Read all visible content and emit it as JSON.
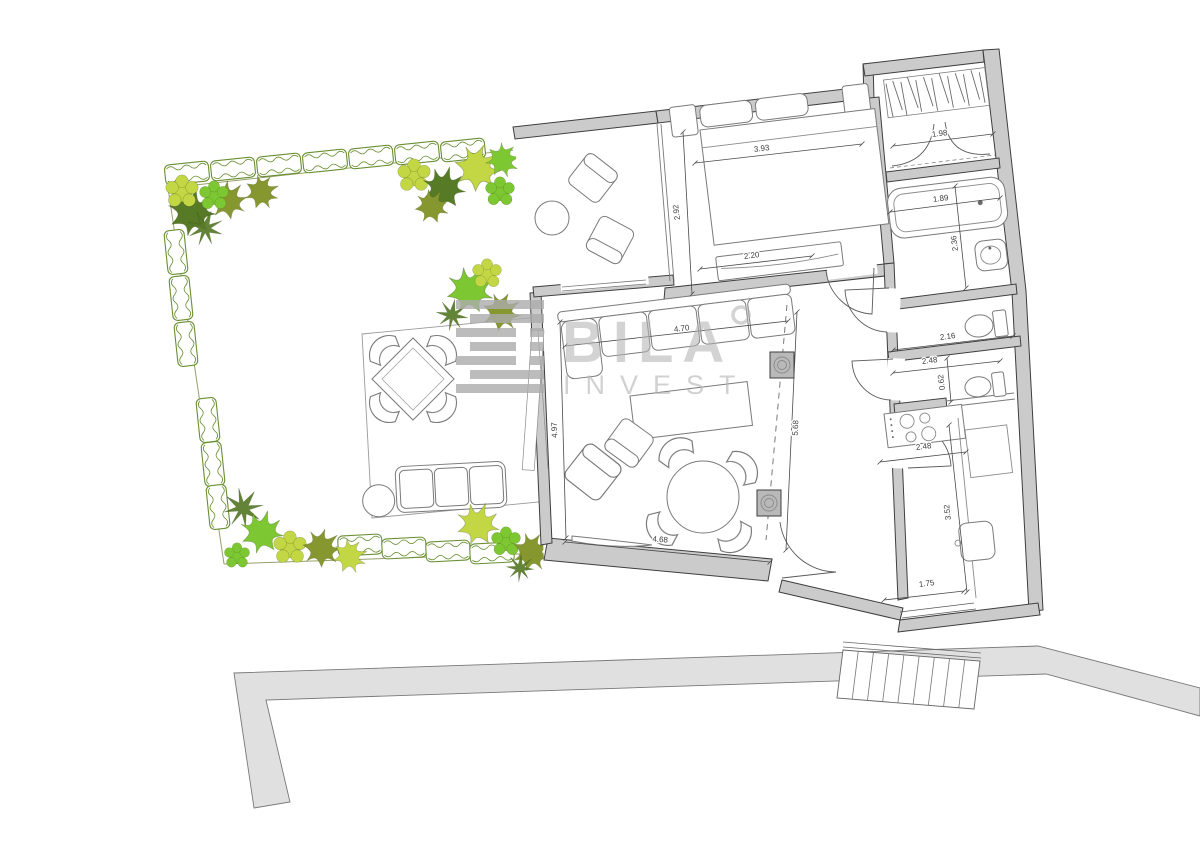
{
  "watermark": {
    "brand": "BILA",
    "sub": "INVEST"
  },
  "colors": {
    "wall_fill": "#cbcbcb",
    "wall_stroke": "#3e3e3e",
    "furniture_stroke": "#7a7a7a",
    "path_fill": "#e0e0e0",
    "watermark_gray": "#b4b4b4",
    "hedge_green": "#6a8f33",
    "plant_bright": "#7dc832",
    "plant_lime": "#c3d745",
    "plant_olive": "#87972f",
    "plant_dark": "#567a26",
    "plant_pale": "#a8cc5a"
  },
  "dimensions": [
    {
      "label": "3.93",
      "x": 762,
      "y": 151,
      "rot": -7,
      "x1": 695,
      "y1": 163,
      "x2": 862,
      "y2": 144
    },
    {
      "label": "2.92",
      "x": 679,
      "y": 212,
      "rot": -97,
      "x1": 683,
      "y1": 132,
      "x2": 692,
      "y2": 294
    },
    {
      "label": "2.20",
      "x": 752,
      "y": 258,
      "rot": -7,
      "x1": 700,
      "y1": 269,
      "x2": 812,
      "y2": 256
    },
    {
      "label": "1.98",
      "x": 940,
      "y": 136,
      "rot": -7,
      "x1": 893,
      "y1": 146,
      "x2": 993,
      "y2": 134
    },
    {
      "label": "1.89",
      "x": 941,
      "y": 201,
      "rot": -7,
      "x1": 890,
      "y1": 212,
      "x2": 1000,
      "y2": 198
    },
    {
      "label": "2.36",
      "x": 957,
      "y": 243,
      "rot": -97,
      "x1": 955,
      "y1": 186,
      "x2": 966,
      "y2": 288
    },
    {
      "label": "2.16",
      "x": 948,
      "y": 339,
      "rot": -7,
      "x1": 893,
      "y1": 350,
      "x2": 1013,
      "y2": 336
    },
    {
      "label": "2.48",
      "x": 930,
      "y": 363,
      "rot": -7,
      "x1": 893,
      "y1": 373,
      "x2": 1000,
      "y2": 361
    },
    {
      "label": "0.62",
      "x": 944,
      "y": 382,
      "rot": -97,
      "x1": 947,
      "y1": 358,
      "x2": 951,
      "y2": 402
    },
    {
      "label": "2.48",
      "x": 924,
      "y": 449,
      "rot": -7,
      "x1": 880,
      "y1": 462,
      "x2": 966,
      "y2": 452
    },
    {
      "label": "3.52",
      "x": 950,
      "y": 512,
      "rot": -96,
      "x1": 949,
      "y1": 425,
      "x2": 967,
      "y2": 592
    },
    {
      "label": "1.75",
      "x": 927,
      "y": 586,
      "rot": -7,
      "x1": 884,
      "y1": 600,
      "x2": 964,
      "y2": 591
    },
    {
      "label": "4.70",
      "x": 682,
      "y": 331,
      "rot": -7,
      "x1": 565,
      "y1": 346,
      "x2": 788,
      "y2": 321
    },
    {
      "label": "4.97",
      "x": 557,
      "y": 430,
      "rot": -92,
      "x1": 560,
      "y1": 322,
      "x2": 566,
      "y2": 538
    },
    {
      "label": "5.68",
      "x": 798,
      "y": 428,
      "rot": -87,
      "x1": 797,
      "y1": 312,
      "x2": 786,
      "y2": 550
    },
    {
      "label": "4.68",
      "x": 660,
      "y": 542,
      "rot": 5,
      "x1": 565,
      "y1": 542,
      "x2": 770,
      "y2": 562
    }
  ],
  "garden": {
    "hedges": [
      {
        "x": 187,
        "y": 173,
        "r": -6
      },
      {
        "x": 233,
        "y": 169,
        "r": -6
      },
      {
        "x": 279,
        "y": 165,
        "r": -6
      },
      {
        "x": 325,
        "y": 161,
        "r": -6
      },
      {
        "x": 371,
        "y": 157,
        "r": -6
      },
      {
        "x": 417,
        "y": 153,
        "r": -6
      },
      {
        "x": 463,
        "y": 150,
        "r": -6
      },
      {
        "x": 176,
        "y": 252,
        "r": 84
      },
      {
        "x": 181,
        "y": 298,
        "r": 84
      },
      {
        "x": 186,
        "y": 344,
        "r": 84
      },
      {
        "x": 208,
        "y": 420,
        "r": 84
      },
      {
        "x": 213,
        "y": 464,
        "r": 84
      },
      {
        "x": 218,
        "y": 507,
        "r": 84
      },
      {
        "x": 360,
        "y": 545,
        "r": -3
      },
      {
        "x": 404,
        "y": 548,
        "r": -3
      },
      {
        "x": 448,
        "y": 551,
        "r": -3
      },
      {
        "x": 492,
        "y": 553,
        "r": -3
      }
    ],
    "plants": [
      {
        "t": "palm",
        "x": 192,
        "y": 212,
        "s": 1.1,
        "r": 10,
        "c": "#567a26"
      },
      {
        "t": "palm",
        "x": 228,
        "y": 200,
        "s": 0.9,
        "r": 40,
        "c": "#87972f"
      },
      {
        "t": "bush",
        "x": 182,
        "y": 192,
        "s": 0.9,
        "r": 0,
        "c": "#c3d745"
      },
      {
        "t": "palm",
        "x": 262,
        "y": 192,
        "s": 0.8,
        "r": 70,
        "c": "#87972f"
      },
      {
        "t": "bush",
        "x": 214,
        "y": 196,
        "s": 0.8,
        "r": 0,
        "c": "#7dc832"
      },
      {
        "t": "fern",
        "x": 205,
        "y": 228,
        "s": 0.9,
        "r": 20,
        "c": "#567a26"
      },
      {
        "t": "bush",
        "x": 414,
        "y": 176,
        "s": 0.9,
        "r": 0,
        "c": "#c3d745"
      },
      {
        "t": "palm",
        "x": 444,
        "y": 188,
        "s": 1.0,
        "r": 15,
        "c": "#567a26"
      },
      {
        "t": "palm",
        "x": 478,
        "y": 168,
        "s": 1.1,
        "r": 55,
        "c": "#c3d745"
      },
      {
        "t": "bush",
        "x": 500,
        "y": 192,
        "s": 0.8,
        "r": 0,
        "c": "#7dc832"
      },
      {
        "t": "palm",
        "x": 432,
        "y": 206,
        "s": 0.8,
        "r": 30,
        "c": "#87972f"
      },
      {
        "t": "palm",
        "x": 503,
        "y": 160,
        "s": 0.8,
        "r": 80,
        "c": "#7dc832"
      },
      {
        "t": "palm",
        "x": 470,
        "y": 290,
        "s": 1.1,
        "r": 25,
        "c": "#7dc832"
      },
      {
        "t": "palm",
        "x": 502,
        "y": 312,
        "s": 0.9,
        "r": 60,
        "c": "#87972f"
      },
      {
        "t": "fern",
        "x": 452,
        "y": 315,
        "s": 0.8,
        "r": 10,
        "c": "#567a26"
      },
      {
        "t": "bush",
        "x": 487,
        "y": 274,
        "s": 0.8,
        "r": 0,
        "c": "#c3d745"
      },
      {
        "t": "fern",
        "x": 243,
        "y": 508,
        "s": 1.0,
        "r": 35,
        "c": "#567a26"
      },
      {
        "t": "palm",
        "x": 262,
        "y": 532,
        "s": 1.0,
        "r": 15,
        "c": "#7dc832"
      },
      {
        "t": "bush",
        "x": 290,
        "y": 548,
        "s": 0.9,
        "r": 0,
        "c": "#c3d745"
      },
      {
        "t": "palm",
        "x": 322,
        "y": 548,
        "s": 0.9,
        "r": 50,
        "c": "#87972f"
      },
      {
        "t": "palm",
        "x": 350,
        "y": 556,
        "s": 0.8,
        "r": 75,
        "c": "#c3d745"
      },
      {
        "t": "bush",
        "x": 237,
        "y": 556,
        "s": 0.7,
        "r": 0,
        "c": "#7dc832"
      },
      {
        "t": "palm",
        "x": 478,
        "y": 524,
        "s": 1.0,
        "r": 20,
        "c": "#c3d745"
      },
      {
        "t": "bush",
        "x": 506,
        "y": 542,
        "s": 0.8,
        "r": 0,
        "c": "#7dc832"
      },
      {
        "t": "palm",
        "x": 532,
        "y": 552,
        "s": 0.9,
        "r": 65,
        "c": "#87972f"
      },
      {
        "t": "fern",
        "x": 520,
        "y": 568,
        "s": 0.7,
        "r": 5,
        "c": "#567a26"
      }
    ]
  },
  "stairs": {
    "steps": 9
  }
}
